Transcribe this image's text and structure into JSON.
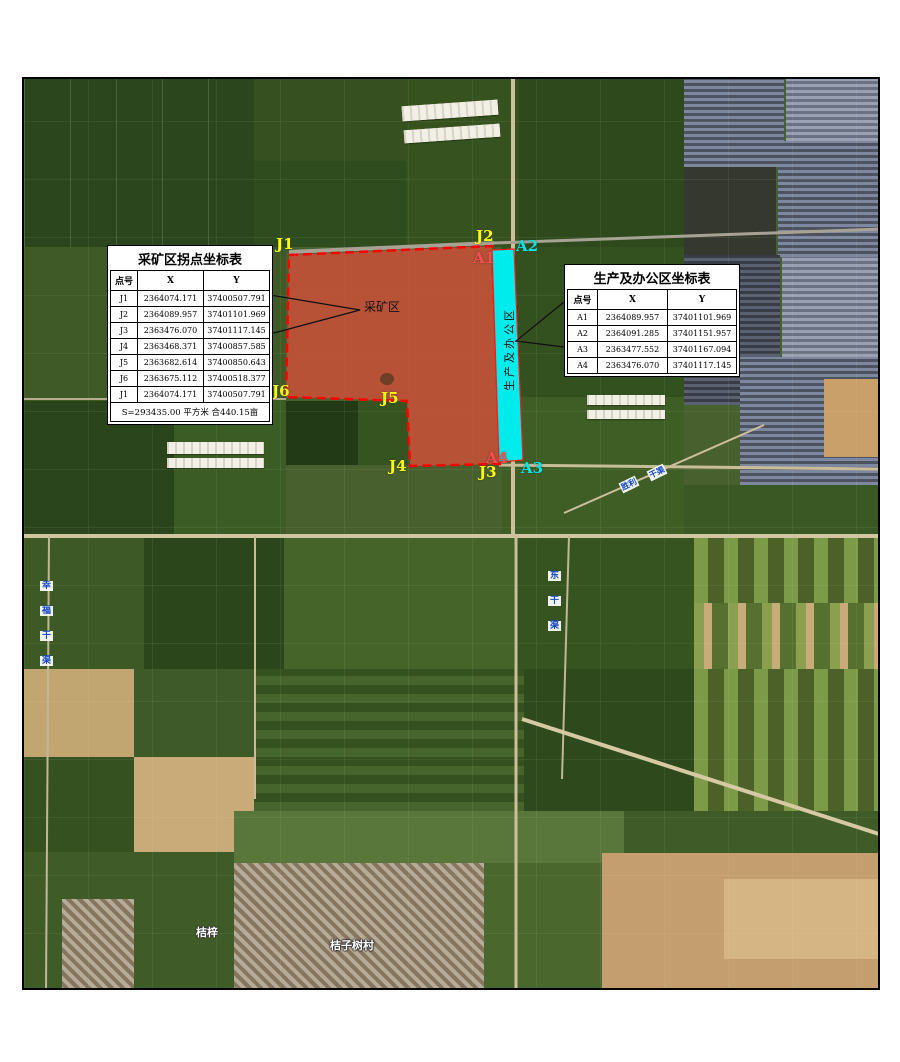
{
  "mining_table": {
    "title": "采矿区拐点坐标表",
    "headers": [
      "点号",
      "X",
      "Y"
    ],
    "rows": [
      [
        "J1",
        "2364074.171",
        "37400507.791"
      ],
      [
        "J2",
        "2364089.957",
        "37401101.969"
      ],
      [
        "J3",
        "2363476.070",
        "37401117.145"
      ],
      [
        "J4",
        "2363468.371",
        "37400857.585"
      ],
      [
        "J5",
        "2363682.614",
        "37400850.643"
      ],
      [
        "J6",
        "2363675.112",
        "37400518.377"
      ],
      [
        "J1",
        "2364074.171",
        "37400507.791"
      ]
    ],
    "footer": "S=293435.00 平方米 合440.15亩"
  },
  "office_table": {
    "title": "生产及办公区坐标表",
    "headers": [
      "点号",
      "X",
      "Y"
    ],
    "rows": [
      [
        "A1",
        "2364089.957",
        "37401101.969"
      ],
      [
        "A2",
        "2364091.285",
        "37401151.957"
      ],
      [
        "A3",
        "2363477.552",
        "37401167.094"
      ],
      [
        "A4",
        "2363476.070",
        "37401117.145"
      ]
    ]
  },
  "labels": {
    "J1": "J1",
    "J2": "J2",
    "J3": "J3",
    "J4": "J4",
    "J5": "J5",
    "J6": "J6",
    "A1": "A1",
    "A2": "A2",
    "A3": "A3",
    "A4": "A4",
    "mining_area": "采矿区",
    "office_strip": "生产及办公区"
  },
  "road_labels": {
    "left_canal": [
      "幸",
      "福",
      "干",
      "渠"
    ],
    "mid_canal": [
      "东",
      "干",
      "渠"
    ],
    "diag_canal": [
      "胜利",
      "干渠"
    ]
  },
  "village_labels": {
    "west": "桔梓",
    "east": "桔子树村"
  },
  "colors": {
    "mining_fill": "#cd5040",
    "mining_stroke": "#ff0000",
    "office_fill": "#00ecec",
    "j_label": "#ffff00",
    "a_label_cyan": "#00e8e8",
    "a_label_red": "#ff4d4d",
    "road_label_blue": "#1547c8",
    "village_label": "#ffffff"
  }
}
